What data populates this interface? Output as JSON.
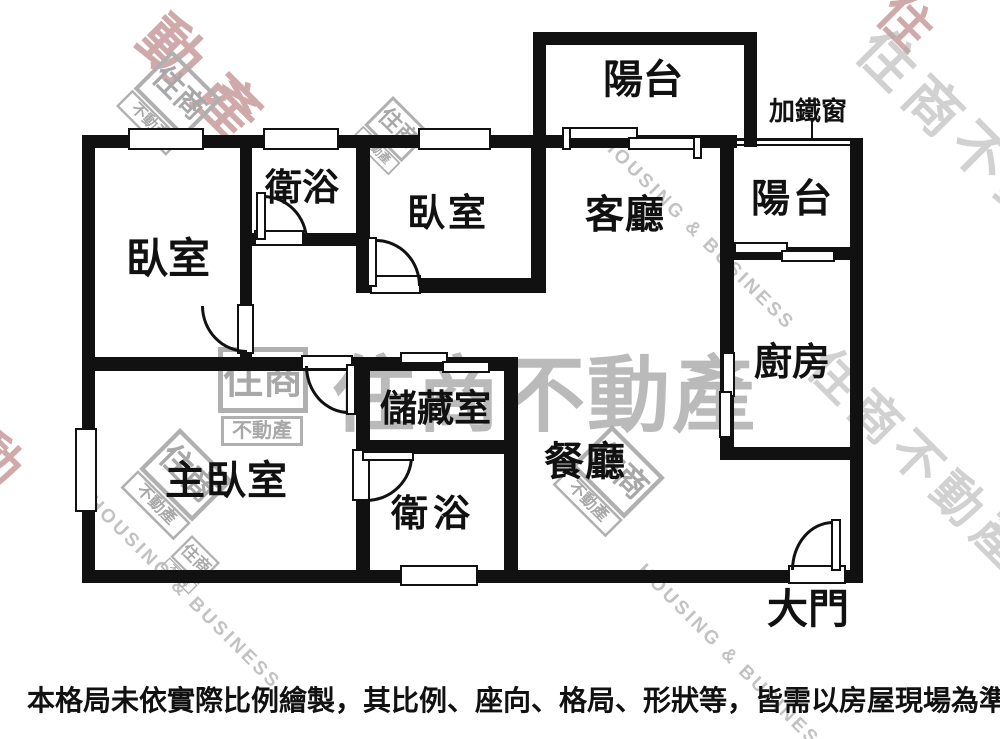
{
  "rooms": {
    "bedroom1": {
      "label": "臥室"
    },
    "bath1": {
      "label": "衛浴"
    },
    "bedroom2": {
      "label": "臥室"
    },
    "living": {
      "label": "客廳"
    },
    "balcony_top": {
      "label": "陽台"
    },
    "balcony_right": {
      "label": "陽台"
    },
    "kitchen": {
      "label": "廚房"
    },
    "master_bedroom": {
      "label": "主臥室"
    },
    "storage": {
      "label": "儲藏室"
    },
    "bath2": {
      "label": "衛浴"
    },
    "dining": {
      "label": "餐廳"
    }
  },
  "annotations": {
    "iron_window_note": "加鐵窗",
    "main_door": "大門"
  },
  "disclaimer": "本格局未依實際比例繪製，其比例、座向、格局、形狀等，皆需以房屋現場為準。",
  "watermark": {
    "brand_full": "住商不動產",
    "brand_part1": "住商",
    "brand_part2": "不動產",
    "brand_en": "HOUSING & BUSINESS",
    "fragment_top_left": "動產",
    "fragment_top_right": "住",
    "fragment_left": "不動"
  },
  "colors": {
    "wall": "#111111",
    "background": "#ffffff",
    "label_text": "#111111",
    "watermark_gray": "#a8a8a8",
    "watermark_red": "#c59595"
  }
}
